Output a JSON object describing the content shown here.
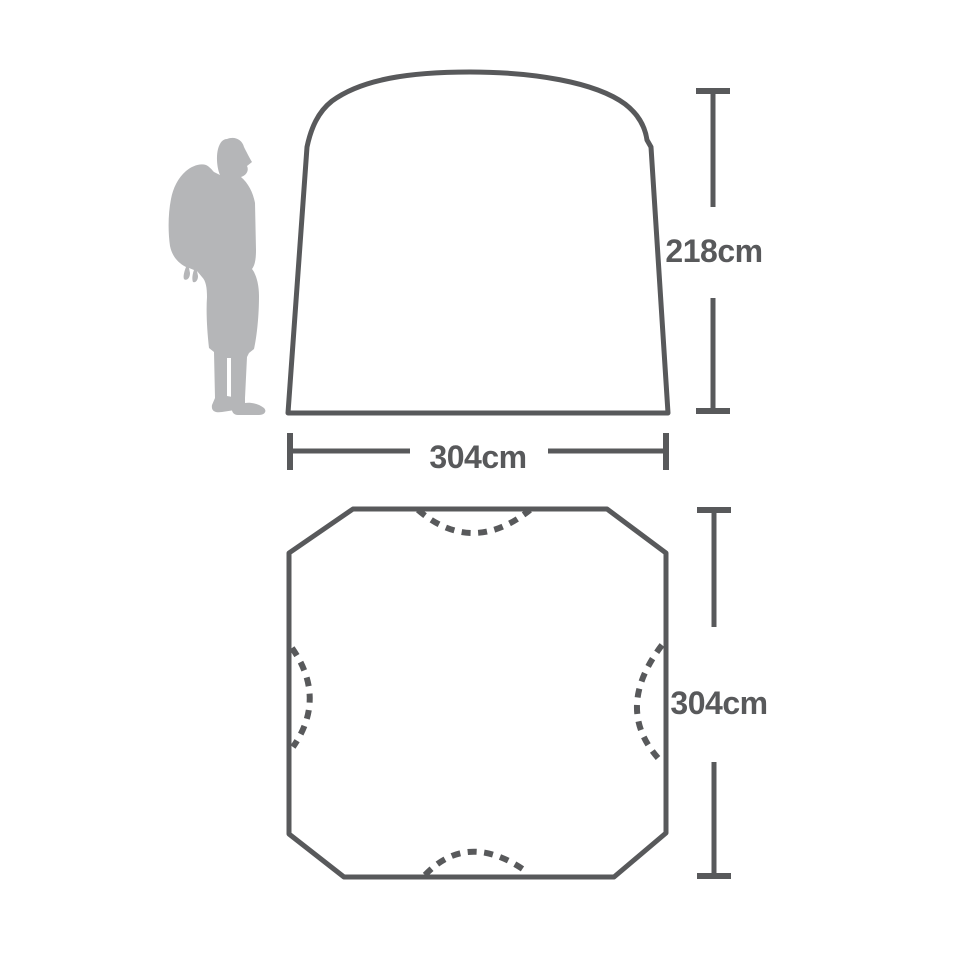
{
  "title": "Tent dimensions diagram",
  "colors": {
    "outline": "#58595b",
    "label_text": "#58595b",
    "silhouette": "#b5b6b8",
    "background": "#ffffff"
  },
  "icons": {
    "scale_figure": "hiker-silhouette-icon",
    "doors": "dashed-door-arc"
  },
  "views": {
    "side_elevation": {
      "dimensions": {
        "height": {
          "label": "218cm",
          "value": 218,
          "unit": "cm"
        },
        "width": {
          "label": "304cm",
          "value": 304,
          "unit": "cm"
        }
      }
    },
    "floor_plan": {
      "door_arc_count": 4,
      "dimensions": {
        "depth": {
          "label": "304cm",
          "value": 304,
          "unit": "cm"
        }
      }
    }
  }
}
